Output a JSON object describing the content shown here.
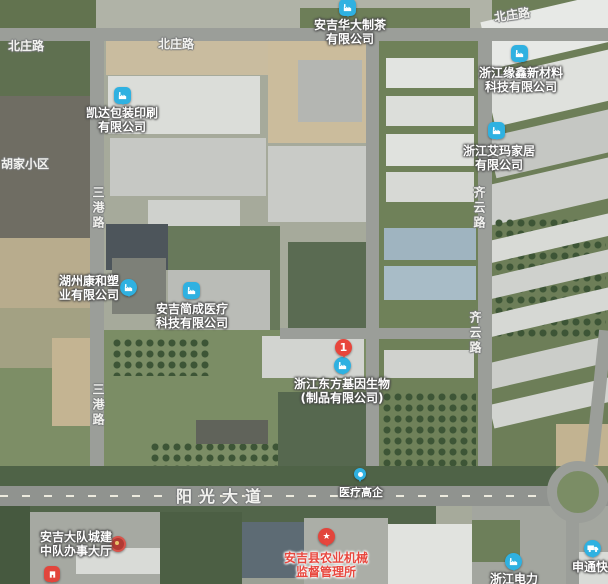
{
  "app": {
    "view": "satellite-map"
  },
  "pois": {
    "huada_tea": {
      "line1": "安吉华大制茶",
      "line2": "有限公司"
    },
    "yuanxin_materials": {
      "line1": "浙江缘鑫新材料",
      "line2": "科技有限公司"
    },
    "aima_home": {
      "line1": "浙江艾玛家居",
      "line2": "有限公司"
    },
    "kaida_printing": {
      "line1": "凯达包装印刷",
      "line2": "有限公司"
    },
    "kanghe_plastics": {
      "line1": "湖州康和塑",
      "line2": "业有限公司"
    },
    "jiancheng_medical": {
      "line1": "安吉简成医疗",
      "line2": "科技有限公司"
    },
    "orient_gene": {
      "marker_number": "1",
      "line1": "浙江东方基因生物",
      "line2": "(制品有限公司)"
    },
    "medical_enterprise_tag": {
      "label": "医疗高企"
    },
    "agri_machinery_bureau": {
      "line1": "安吉县农业机械",
      "line2": "监督管理所",
      "star": "★"
    },
    "service_hall": {
      "line1": "安吉大队城建",
      "line2": "中队办事大厅"
    },
    "zhejiang_electric": {
      "label": "浙江电力"
    },
    "shentong_express": {
      "label": "申通快递"
    }
  },
  "road_labels": {
    "beizhuang_west": "北庄路",
    "beizhuang_mid": "北庄路",
    "beizhuang_east": "北庄路",
    "sangang_north": "三港路",
    "sangang_south": "三港路",
    "qiyun_north": "齐云路",
    "qiyun_south": "齐云路",
    "yangguang_avenue": "阳光大道"
  },
  "area_labels": {
    "hujia_residential": "胡家小区"
  },
  "icons": {
    "factory_poi": "blue rounded square, white factory glyph",
    "numbered_pin": "red pin with number",
    "star_poi": "red circle with white star",
    "gov_badge": "red round emblem badge",
    "truck_poi": "blue circle with white truck",
    "dot_pin": "blue teardrop with white dot"
  },
  "colors": {
    "poi_blue": "#2fb1e1",
    "marker_red": "#e8463c",
    "label_red": "#e8473e",
    "road_gray": "#9b9e99",
    "field_green": "#7b8d65",
    "tree_green": "#3d5536"
  }
}
